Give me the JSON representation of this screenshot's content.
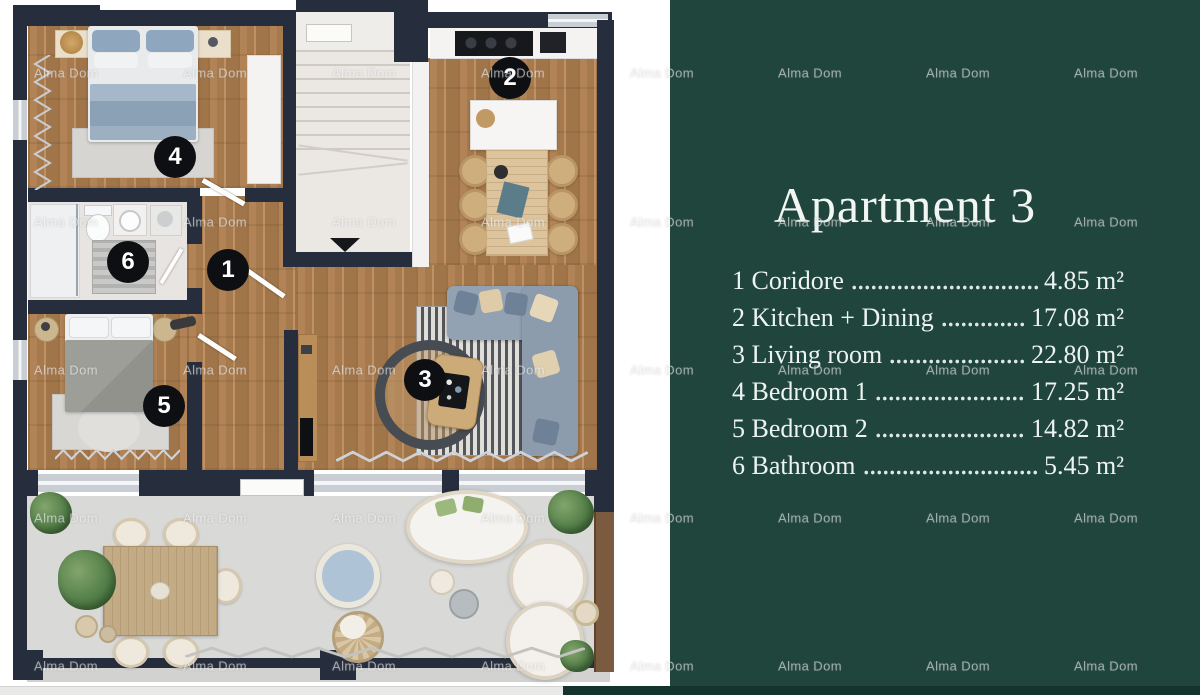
{
  "watermark": {
    "text": "Alma Dom"
  },
  "floorplan": {
    "badges": [
      "1",
      "2",
      "3",
      "4",
      "5",
      "6"
    ]
  },
  "panel": {
    "title": "Apartment 3",
    "rooms": [
      {
        "label": "1 Coridore",
        "value": "4.85 m²"
      },
      {
        "label": "2 Kitchen + Dining",
        "value": "17.08 m²"
      },
      {
        "label": "3 Living room",
        "value": "22.80 m²"
      },
      {
        "label": "4 Bedroom 1",
        "value": "17.25 m²"
      },
      {
        "label": "5 Bedroom 2",
        "value": "14.82 m²"
      },
      {
        "label": "6 Bathroom",
        "value": "5.45 m²"
      }
    ]
  },
  "colors": {
    "panel_green": "#1f453c",
    "panel_green_dark": "#14332c",
    "wall_navy": "#262e3d",
    "wood": "#ab7e51",
    "terrace_gray": "#d9d9d7",
    "badge_black": "#0e0f12",
    "text_light": "#edf3f0"
  }
}
